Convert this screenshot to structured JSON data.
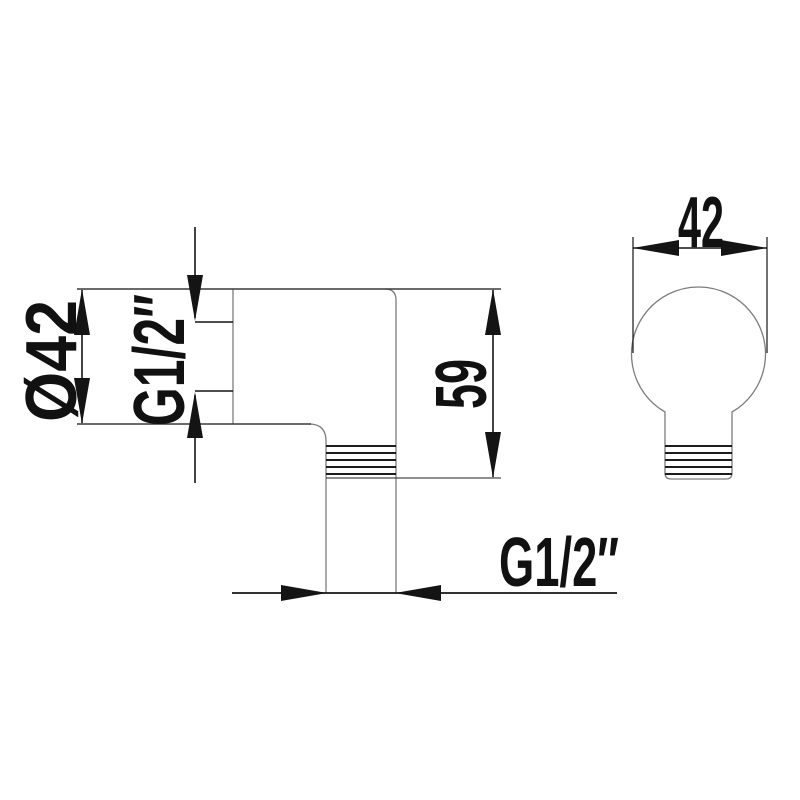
{
  "drawing": {
    "labels": {
      "front_width": "42",
      "side_diameter": "Ø42",
      "side_thread": "G1/2″",
      "side_height": "59",
      "bottom_thread": "G1/2″"
    },
    "colors": {
      "background": "#ffffff",
      "outline": "#7d7d7d",
      "edge_dark": "#3a3a3a",
      "thread": "#1c1c1c",
      "dimension": "#141414",
      "text": "#111111"
    }
  }
}
